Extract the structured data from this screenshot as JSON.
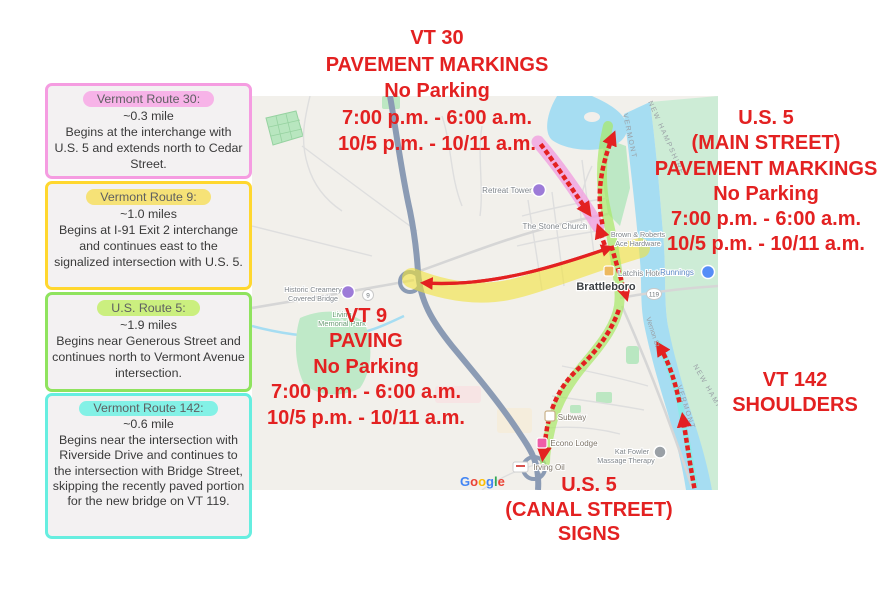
{
  "colors": {
    "annotation_red": "#e32121",
    "vt30_pink_border": "#f59ce1",
    "vt9_yellow_border": "#ffd72e",
    "us5_green_border": "#8fe35e",
    "vt142_cyan_border": "#66eee0",
    "vt9_route_highlight": "#f2e23c",
    "vt30_route_highlight": "#f0a0e0",
    "us5_route_highlight": "#a8e867",
    "vt142_route_highlight": "#7fefe2"
  },
  "legend": [
    {
      "title": "Vermont Route 30:",
      "length": "~0.3 mile",
      "desc": "Begins at the interchange with U.S. 5 and extends north to Cedar Street."
    },
    {
      "title": "Vermont Route 9:",
      "length": "~1.0 miles",
      "desc": "Begins at I-91 Exit 2 interchange and continues east to the signalized intersection with U.S. 5."
    },
    {
      "title": "U.S. Route 5:",
      "length": "~1.9 miles",
      "desc": "Begins near Generous Street and continues north to Vermont Avenue intersection."
    },
    {
      "title": "Vermont Route 142:",
      "length": "~0.6 mile",
      "desc": "Begins near the intersection with Riverside Drive and continues to the intersection with Bridge Street, skipping the recently paved portion for the new bridge on VT 119."
    }
  ],
  "callouts": {
    "vt30": [
      "VT 30",
      "PAVEMENT MARKINGS",
      "No Parking",
      "7:00 p.m. - 6:00 a.m.",
      "10/5 p.m. - 10/11 a.m."
    ],
    "us5_main": [
      "U.S. 5",
      "(MAIN STREET)",
      "PAVEMENT MARKINGS",
      "No Parking",
      "7:00 p.m. - 6:00 a.m.",
      "10/5 p.m. - 10/11 a.m."
    ],
    "vt9": [
      "VT 9",
      "PAVING",
      "No Parking",
      "7:00 p.m. - 6:00 a.m.",
      "10/5 p.m. - 10/11 a.m."
    ],
    "us5_canal": [
      "U.S. 5",
      "(CANAL STREET)",
      "SIGNS"
    ],
    "vt142": [
      "VT 142",
      "SHOULDERS"
    ]
  },
  "map": {
    "labels": {
      "retreat_tower": "Retreat Tower",
      "stone_church": "The Stone Church",
      "brown_roberts_1": "Brown & Roberts",
      "brown_roberts_2": "Ace Hardware",
      "latchis": "Latchis Hotel",
      "runnings": "Runnings",
      "brattleboro": "Brattleboro",
      "covered_bridge_1": "Historic Creamery",
      "covered_bridge_2": "Covered Bridge",
      "memorial_park_1": "Living",
      "memorial_park_2": "Memorial Park",
      "subway": "Subway",
      "econo_lodge": "Econo Lodge",
      "irving_oil": "Irving Oil",
      "kat_fowler_1": "Kat Fowler",
      "kat_fowler_2": "Massage Therapy",
      "vernon_st": "Vernon St"
    },
    "shields": {
      "route9": "9",
      "route119": "119"
    },
    "states": {
      "vermont": "VERMONT",
      "new_hampshire": "NEW HAMPSHIRE"
    },
    "google_letters": [
      "G",
      "o",
      "o",
      "g",
      "l",
      "e"
    ]
  }
}
